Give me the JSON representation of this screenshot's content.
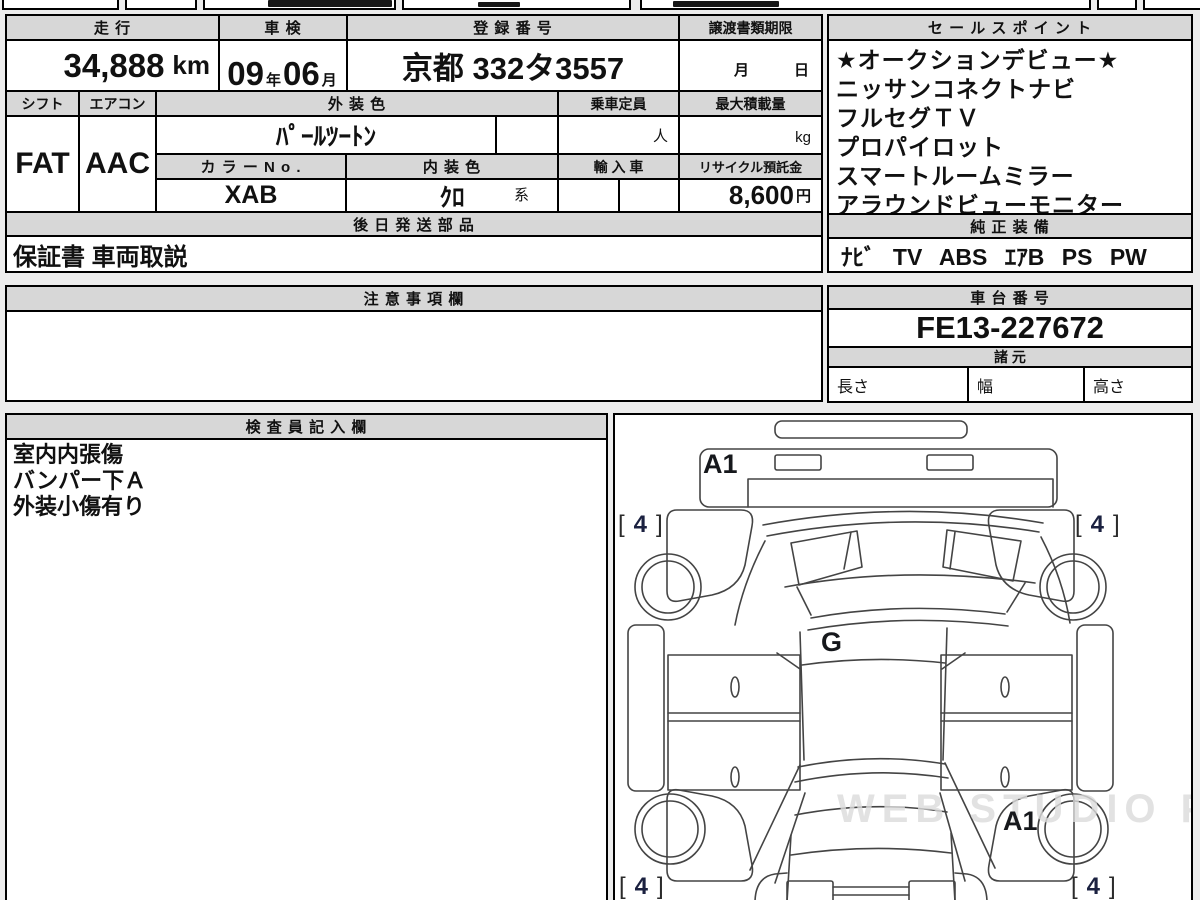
{
  "colors": {
    "header_bg": "#d7d7d7",
    "border": "#000000",
    "tire_depth_ink": "#1b2140",
    "watermark": "#dcdcdc"
  },
  "main_table": {
    "mileage_label": "走 行",
    "mileage_value": "34,888",
    "mileage_unit": "km",
    "inspection_label": "車 検",
    "inspection_year": "09",
    "inspection_year_unit": "年",
    "inspection_month": "06",
    "inspection_month_unit": "月",
    "registration_label": "登 録 番 号",
    "registration_value": "京都 332タ3557",
    "transfer_label": "譲渡書類期限",
    "transfer_value": "月　　　日",
    "shift_label": "シフト",
    "shift_value": "FAT",
    "aircon_label": "エアコン",
    "aircon_value": "AAC",
    "exterior_color_label": "外 装 色",
    "exterior_color_value": "ﾊﾟｰﾙﾂｰﾄﾝ",
    "capacity_label": "乗車定員",
    "capacity_unit": "人",
    "max_load_label": "最大積載量",
    "max_load_unit": "kg",
    "color_no_label": "カ ラ ー N o .",
    "color_no_value": "XAB",
    "interior_color_label": "内 装 色",
    "interior_color_value": "ｸﾛ",
    "interior_color_suffix": "系",
    "import_label": "輸 入 車",
    "recycle_label": "リサイクル預託金",
    "recycle_value": "8,600",
    "recycle_unit": "円",
    "later_parts_label": "後 日 発 送 部 品",
    "later_parts_value": "保証書 車両取説"
  },
  "sales_points": {
    "label": "セ ー ル ス ポ イ ン ト",
    "items": [
      "★オークションデビュー★",
      "ニッサンコネクトナビ",
      "フルセグＴＶ",
      "プロパイロット",
      "スマートルームミラー",
      "アラウンドビューモニター"
    ]
  },
  "equipment": {
    "label": "純 正 装 備",
    "value": "ﾅﾋﾞ TV ABS ｴｱB PS PW"
  },
  "notes": {
    "label": "注 意 事 項 欄",
    "value": ""
  },
  "chassis": {
    "label": "車 台 番 号",
    "value": "FE13-227672"
  },
  "specs": {
    "label": "諸 元",
    "length_label": "長さ",
    "width_label": "幅",
    "height_label": "高さ"
  },
  "inspector": {
    "label": "検 査 員 記 入 欄",
    "lines": [
      "室内内張傷",
      "バンパー下Ａ",
      "外装小傷有り"
    ]
  },
  "diagram": {
    "panel_label_front": "A1",
    "panel_label_gate": "G",
    "panel_label_rear": "A1",
    "bracket_open": "[",
    "tire_depth": "4",
    "bracket_close": "]",
    "watermark": "WEB STUDIO PRO"
  }
}
